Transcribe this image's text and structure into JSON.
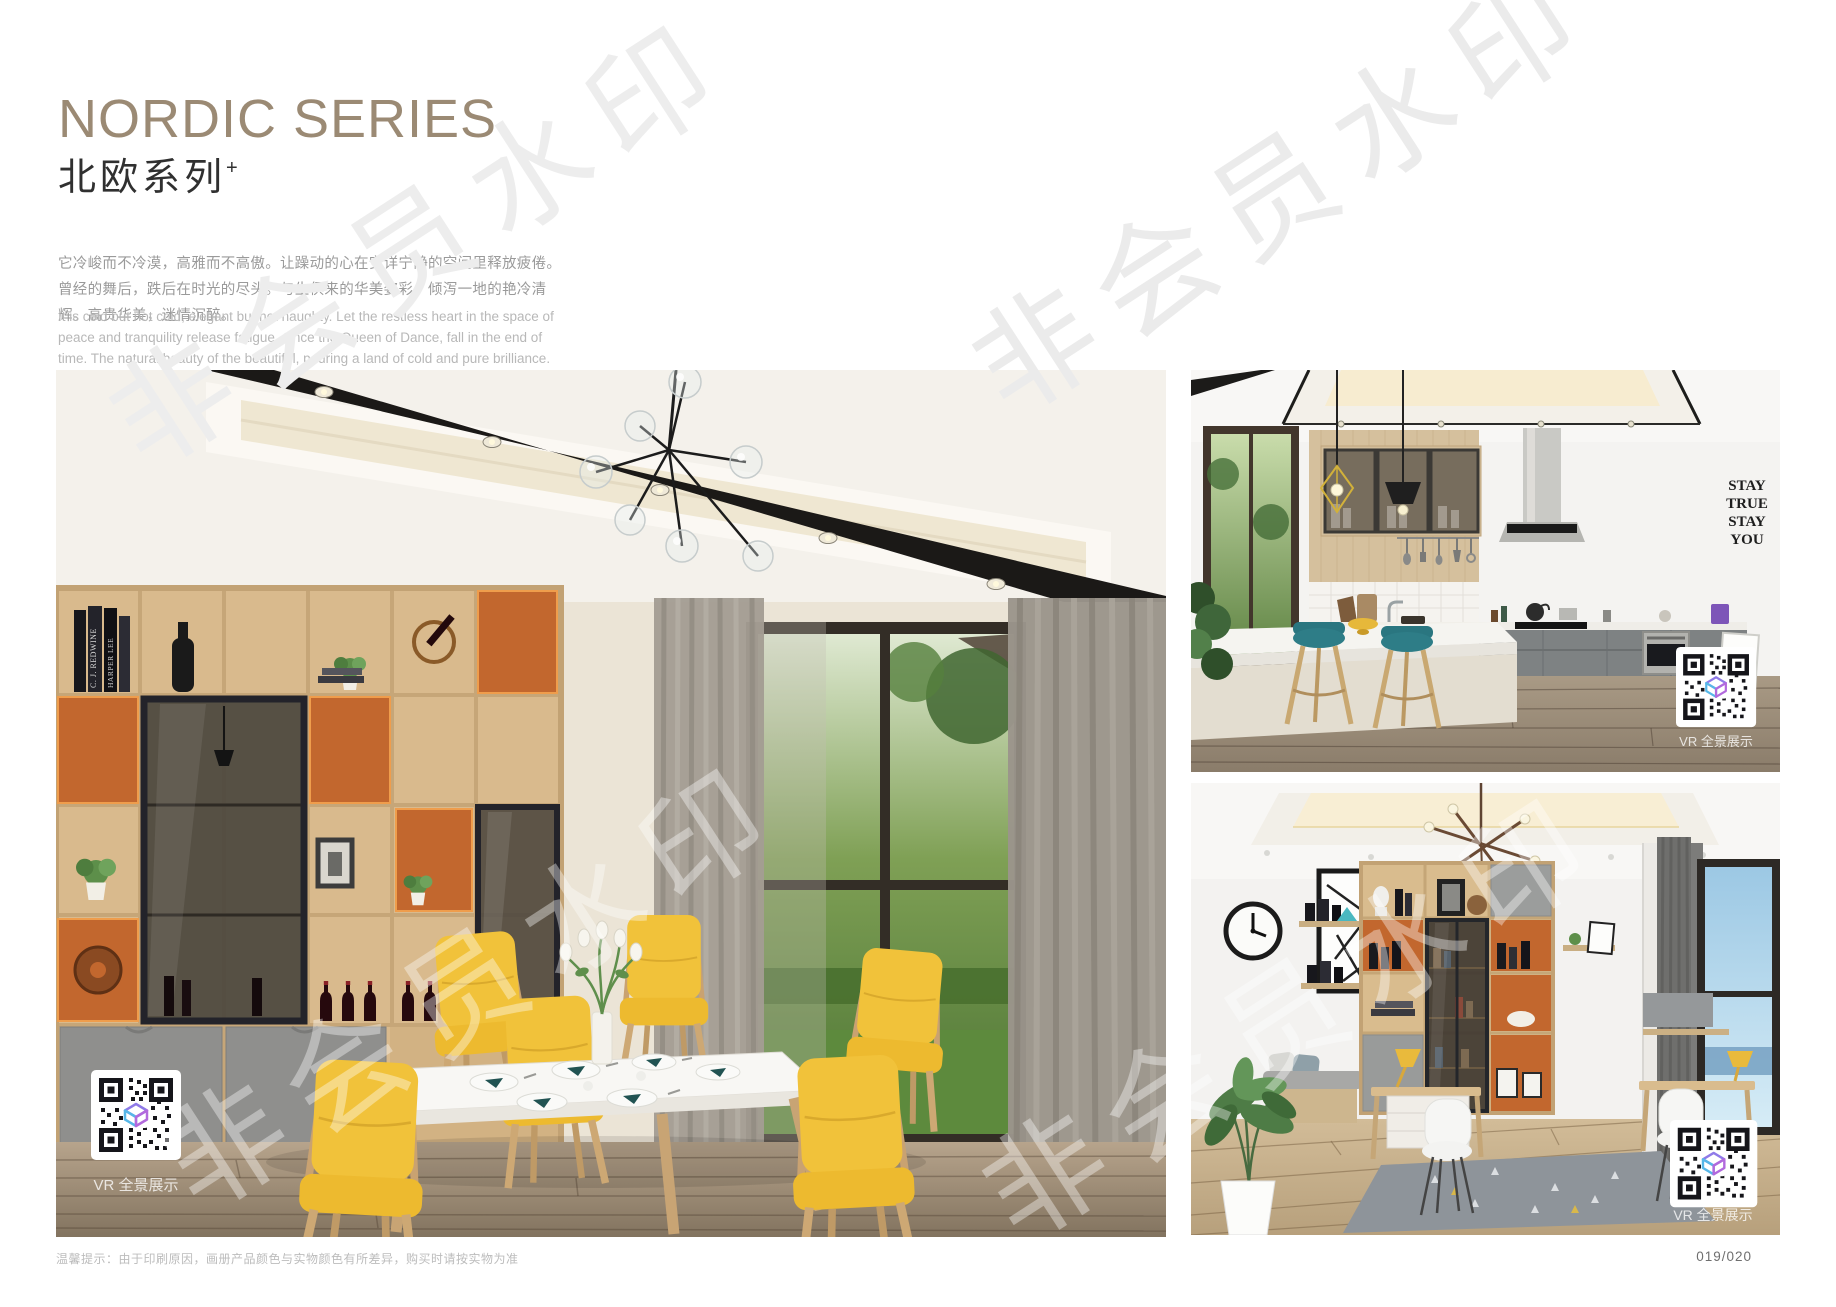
{
  "page": {
    "title_en": "NORDIC SERIES",
    "title_zh": "北欧系列",
    "title_superscript": "+",
    "intro_zh": "它冷峻而不冷漠，高雅而不高傲。让躁动的心在安详宁静的空间里释放疲倦。曾经的舞后，跌后在时光的尽头。与生俱来的华美姿彩，倾泻一地的艳冷清辉。高贵华美，迷情沉醉。",
    "intro_en": "It is cold but not cold, elegant but not haughty. Let the restless heart in the space of peace and tranquility release fatigue. Once the Queen of Dance, fall in the end of time. The natural beauty of the beautiful, pouring a land of cold and pure brilliance. Noble, beautiful, enchanted.",
    "footer_note": "温馨提示：由于印刷原因，画册产品颜色与实物颜色有所差异，购买时请按实物为准",
    "page_number": "019/020",
    "watermark_text": "非会员水印",
    "vr_label": "VR 全景展示"
  },
  "photo_texts": {
    "kitchen_wall_decal": [
      "STAY",
      "TRUE",
      "STAY",
      "YOU"
    ],
    "book_spines": [
      "C. J. REDWINE",
      "HARPER LEE"
    ]
  },
  "colors": {
    "title_brown": "#9b8a74",
    "accent_orange": "#c2672e",
    "chair_yellow": "#f1c23a",
    "stool_teal": "#2e7d87",
    "shelf_wood": "#d9ba8d"
  }
}
